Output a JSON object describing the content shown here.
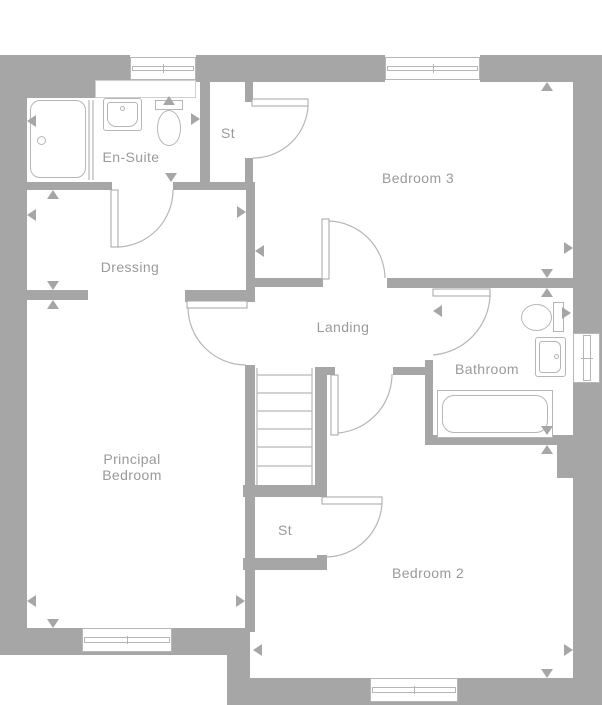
{
  "plan": {
    "type": "floor-plan",
    "floor": "first-floor",
    "colors": {
      "wall": "#a6a6a6",
      "line": "#b6b6b6",
      "text": "#9a9a9a",
      "background": "#ffffff"
    },
    "rooms": {
      "ensuite": {
        "label": "En-Suite"
      },
      "storage_top": {
        "label": "St"
      },
      "bedroom3": {
        "label": "Bedroom 3"
      },
      "dressing": {
        "label": "Dressing"
      },
      "landing": {
        "label": "Landing"
      },
      "bathroom": {
        "label": "Bathroom"
      },
      "principal": {
        "label": "Principal Bedroom"
      },
      "storage_bottom": {
        "label": "St"
      },
      "bedroom2": {
        "label": "Bedroom 2"
      }
    },
    "fixtures": [
      {
        "room": "ensuite",
        "type": "shower-tray"
      },
      {
        "room": "ensuite",
        "type": "wash-basin"
      },
      {
        "room": "ensuite",
        "type": "toilet"
      },
      {
        "room": "bathroom",
        "type": "toilet"
      },
      {
        "room": "bathroom",
        "type": "wash-basin"
      },
      {
        "room": "bathroom",
        "type": "bath"
      },
      {
        "room": "landing",
        "type": "staircase"
      }
    ],
    "window_count": 5,
    "door_count": 7
  }
}
